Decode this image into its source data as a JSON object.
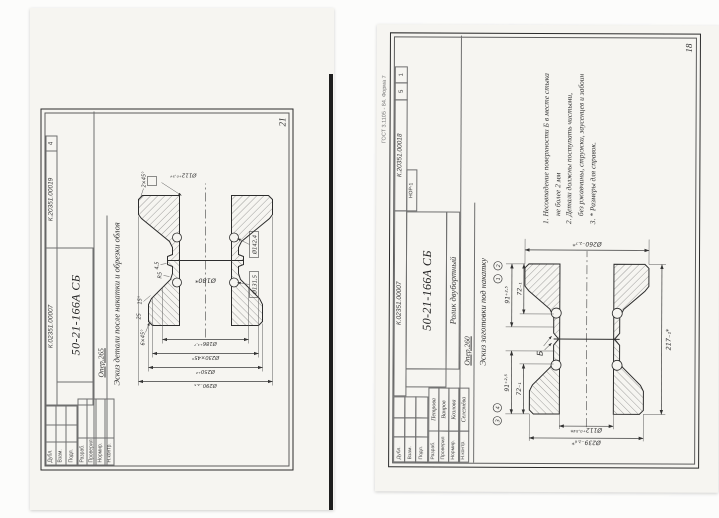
{
  "left_page": {
    "page_number": "21",
    "header": {
      "doc_no": "К.02351.00007",
      "sketch_no": "К.20351.00019",
      "sheet_count": "4",
      "part_no": "50-21-166А СБ",
      "operation": "Опер.265",
      "subtitle": "Эскиз детали после накатки и обрезки облоя",
      "stamp_labels": [
        "Дубл.",
        "Взам.",
        "Подл."
      ],
      "sig_labels": [
        "Разраб.",
        "Проверил",
        "Нормир.",
        "Н.контр."
      ]
    },
    "figure": {
      "bore": "Ø112⁺⁰·⁵⁴",
      "center_dia": "Ø180*",
      "dia_chain": [
        "Ø186⁺¹·⁷",
        "Ø230×45°",
        "Ø250⁺²",
        "Ø290₋₂.₅"
      ],
      "chamfer": "6×45°",
      "angle": "15°",
      "radius": "R5",
      "width": "25",
      "web": "4,5",
      "chamfer2": "2×45°",
      "box_dims": [
        "Ø131,5",
        "Ø142,4"
      ]
    }
  },
  "right_page": {
    "page_number": "18",
    "form_note": "ГОСТ 3.1105 - 84. Форма 7",
    "header": {
      "doc_no": "К.02351.00007",
      "sketch_no": "К.20351.00018",
      "sheet_a": "5",
      "sheet_b": "1",
      "code": "НОР-1",
      "part_no": "50-21-166А СБ",
      "part_name": "Ролик двубортный",
      "operation": "Опер.260",
      "subtitle": "Эскиз заготовки под накатку",
      "stamp_labels": [
        "Дубл.",
        "Взам.",
        "Подл."
      ],
      "signatures": [
        {
          "role": "Разраб.",
          "name": "Петрова"
        },
        {
          "role": "Проверил",
          "name": "Ванров"
        },
        {
          "role": "Нормир.",
          "name": "Козлова"
        },
        {
          "role": "Н.контр.",
          "name": "Селезнёва"
        }
      ]
    },
    "notes": [
      "1. Несовпадение поверхности Б в месте стыка",
      "не более 2 мм",
      "2. Детали должны поступать чистыми,",
      "без ржавчины, стружки, заусенцев и забоин",
      "3. * Размеры для справок."
    ],
    "figure": {
      "od_right": "Ø260₋₂.₇*",
      "od_left": "Ø239₋₂.₆*",
      "bore": "Ø112⁺⁰·⁵⁴*",
      "length": "217₋₁*",
      "flange_w": "91⁺²·⁵",
      "hub_w": "72₋₁",
      "datum": "Б",
      "refs": [
        "1",
        "2",
        "3",
        "4"
      ]
    }
  }
}
